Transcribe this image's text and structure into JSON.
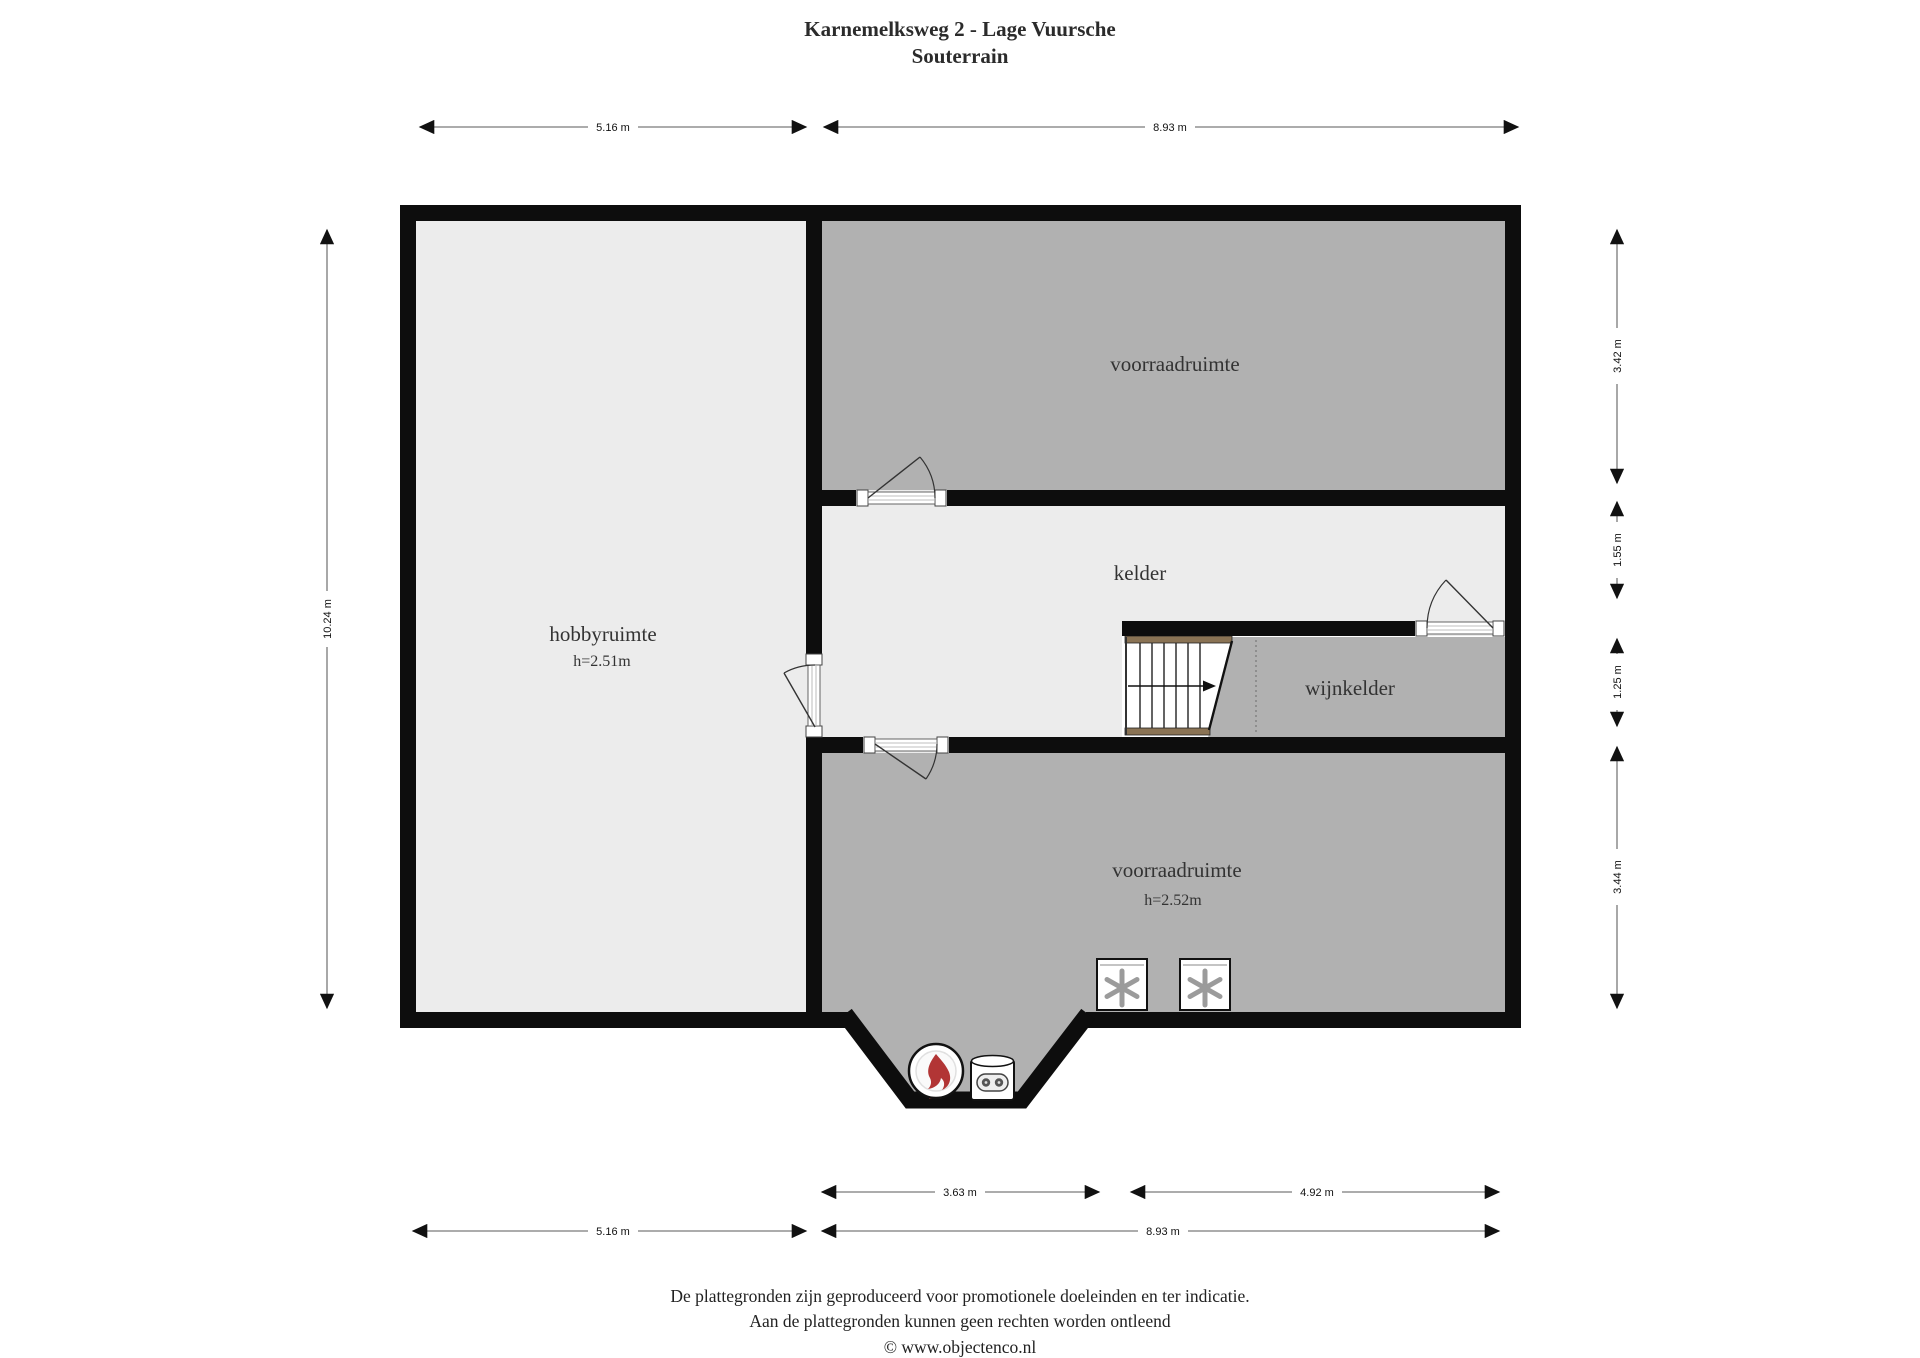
{
  "title": {
    "line1": "Karnemelksweg 2 - Lage Vuursche",
    "line2": "Souterrain"
  },
  "rooms": {
    "voorraad_top": {
      "label": "voorraadruimte"
    },
    "kelder": {
      "label": "kelder"
    },
    "wijnkelder": {
      "label": "wijnkelder"
    },
    "hobbyruimte": {
      "label": "hobbyruimte",
      "height": "h=2.51m"
    },
    "voorraad_bottom": {
      "label": "voorraadruimte",
      "height": "h=2.52m"
    }
  },
  "dimensions": {
    "top_left": "5.16 m",
    "top_right": "8.93 m",
    "left_total": "10.24 m",
    "right_1": "3.42 m",
    "right_2": "1.55 m",
    "right_3": "1.25 m",
    "right_4": "3.44 m",
    "bottom_inner_left": "3.63 m",
    "bottom_inner_right": "4.92 m",
    "bottom_outer_left": "5.16 m",
    "bottom_outer_right": "8.93 m"
  },
  "footer": {
    "line1": "De plattegronden zijn geproduceerd voor promotionele doeleinden en ter indicatie.",
    "line2": "Aan de plattegronden kunnen geen rechten worden ontleend",
    "line3": "© www.objectenco.nl"
  },
  "colors": {
    "room_dark": "#b1b1b1",
    "room_light": "#ececec",
    "wall": "#0d0d0d",
    "stair_rail": "#8a7354",
    "dimension_line": "#7a7a7a",
    "flame_red": "#b23535",
    "asterisk_gray": "#9b9b9b"
  }
}
